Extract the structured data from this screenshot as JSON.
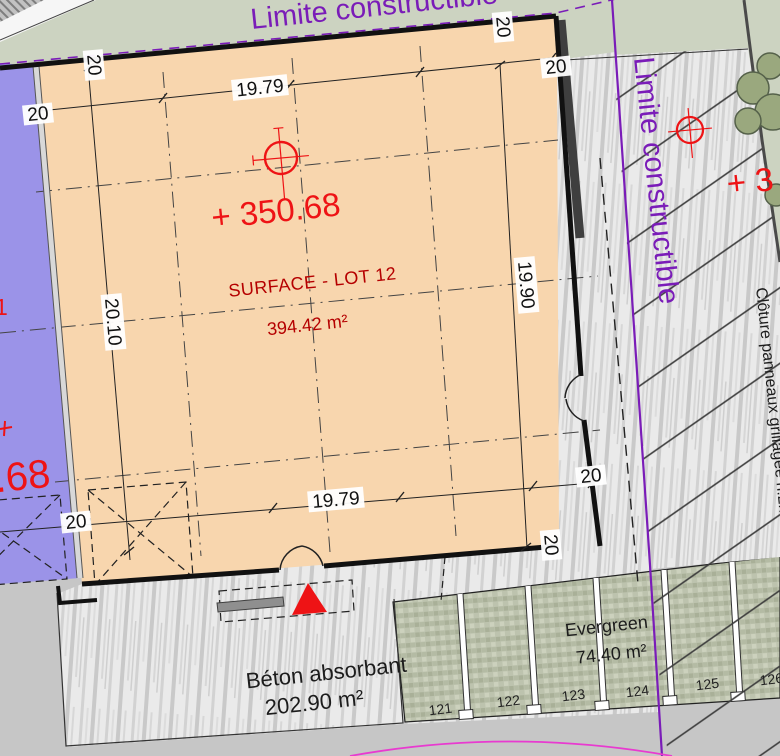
{
  "annotations": {
    "limite_top": "Limite constructible",
    "limite_right": "Limite constructible",
    "cloture": "Clôture panneaux grillagée h:2m",
    "elevation_main": "+ 350.68",
    "elevation_right_partial": "+ 3",
    "elevation_left_partial": ".68",
    "elevation_left_fragment": "1",
    "surface_label": "SURFACE - LOT 12",
    "surface_area": "394.42 m²",
    "beton_label": "Béton absorbant",
    "beton_area": "202.90 m²",
    "evergreen_label": "Evergreen",
    "evergreen_area": "74.40 m²"
  },
  "dimensions": {
    "top": "19.79",
    "bottom": "19.79",
    "left": "20.10",
    "right": "19.90",
    "wall": "20"
  },
  "parking": {
    "stalls": [
      "121",
      "122",
      "123",
      "124",
      "125",
      "126"
    ]
  },
  "colors": {
    "grass_green": "#ccd3c1",
    "lot_blue": "#9b93e8",
    "lot_orange": "#f8d6ae",
    "gray_ground": "#c6c6c6",
    "concrete": "#eaeaea",
    "paver_green": "#bdc3ae",
    "limite_purple": "#7a1cb8",
    "magenta_line": "#e83ad0",
    "red_label": "#ee1315",
    "maroon_label": "#b50000",
    "black_text": "#1c1c1c"
  }
}
